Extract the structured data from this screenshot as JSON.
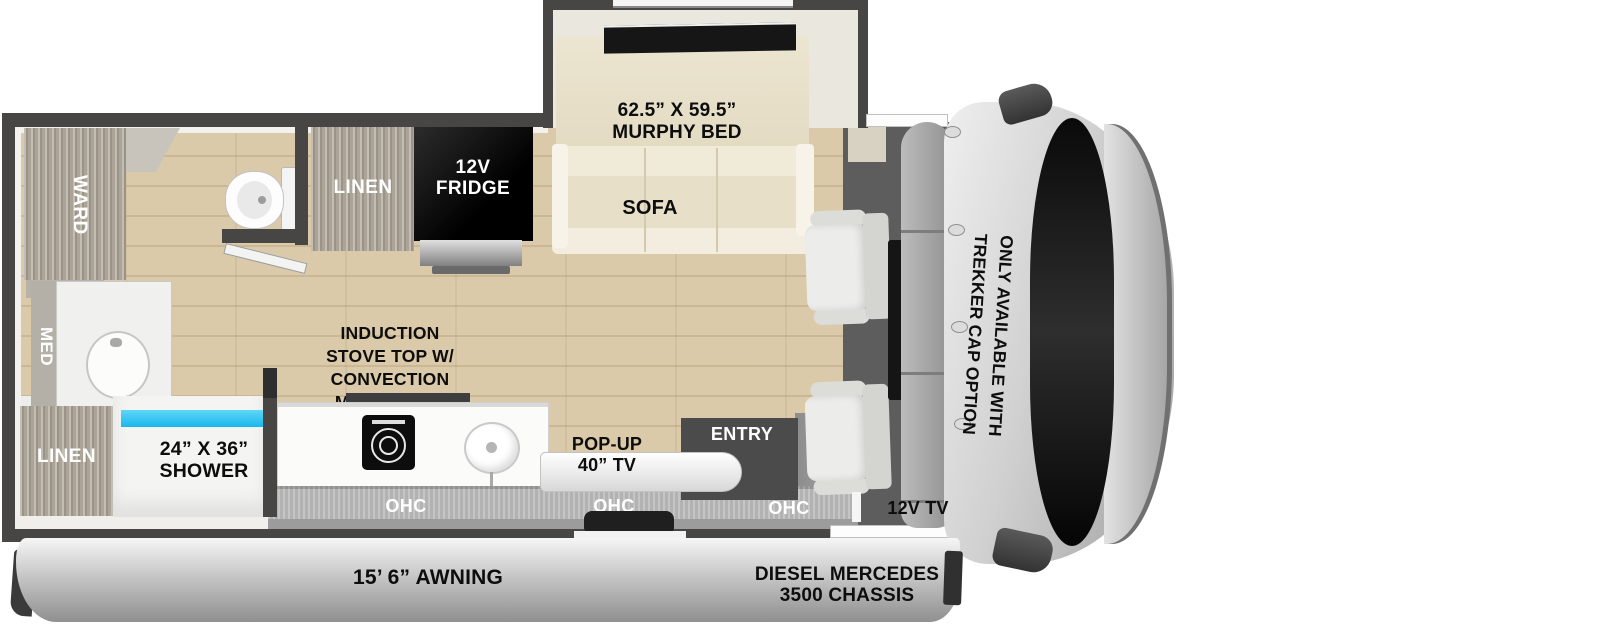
{
  "title": "RV floor plan with murphy bed slideout and trekker cap",
  "labels": {
    "murphy_bed_size": "62.5” X 59.5”",
    "murphy_bed": "MURPHY BED",
    "sofa": "SOFA",
    "linen_kitchen": "LINEN",
    "fridge_l1": "12V",
    "fridge_l2": "FRIDGE",
    "stove_l1": "INDUCTION",
    "stove_l2": "STOVE TOP W/",
    "stove_l3": "CONVECTION",
    "stove_l4": "MICROWAVE",
    "popup_tv_l1": "POP-UP",
    "popup_tv_l2": "40” TV",
    "entry": "ENTRY",
    "ohc_1": "OHC",
    "ohc_2": "OHC",
    "ohc_3": "OHC",
    "tv_12v": "12V TV",
    "ward": "WARD",
    "med": "MED",
    "linen_bath": "LINEN",
    "shower_l1": "24” X 36”",
    "shower_l2": "SHOWER",
    "cab_note_l1": "ONLY AVAILABLE WITH",
    "cab_note_l2": "TREKKER CAP OPTION",
    "awning": "15’ 6” AWNING",
    "chassis_l1": "DIESEL MERCEDES",
    "chassis_l2": "3500 CHASSIS"
  },
  "colors": {
    "wall": "#474645",
    "floor_tan": "#dbcaa9",
    "furniture_cream": "#ebe4d0",
    "shower_water": "#31c7f3",
    "fridge_black": "#111111",
    "cab_gray": "#d0d0d0",
    "awning_silver": "#c9c9c9",
    "text_dark": "#0d0d0d",
    "text_light": "#ffffff"
  }
}
